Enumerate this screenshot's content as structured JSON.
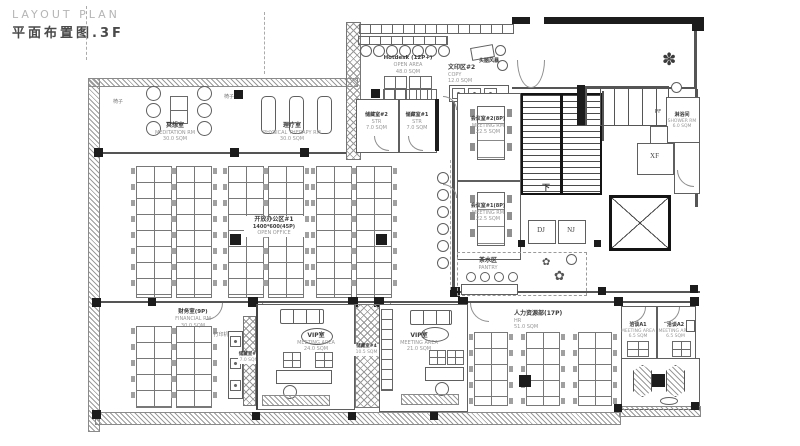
{
  "title": {
    "en": "LAYOUT PLAN",
    "zh": "平面布置图.3F"
  },
  "rooms": {
    "meditation": {
      "name": "冥想室",
      "sub": "MEDITATION RM",
      "area": "30.0 SQM"
    },
    "therapy": {
      "name": "理疗室",
      "sub": "PHYSICAL THERAPY RM",
      "area": "30.0 SQM"
    },
    "hotdesk": {
      "name": "Hotdesk (12P+)",
      "sub": "OPEN AREA",
      "area": "48.0 SQM"
    },
    "brainstorm": {
      "name": "头脑风暴"
    },
    "copy": {
      "name": "文印区#2",
      "sub": "COPY",
      "area": "12.0 SQM"
    },
    "storage2": {
      "name": "储藏室#2",
      "sub": "STR",
      "area": "7.0 SQM"
    },
    "storage1": {
      "name": "储藏室#1",
      "sub": "STR",
      "area": "7.0 SQM"
    },
    "meeting2": {
      "name": "会议室#2(8P)",
      "sub": "MEETING RM",
      "area": "22.5 SQM"
    },
    "meeting1": {
      "name": "会议室#1(8P)",
      "sub": "MEETING RM",
      "area": "22.5 SQM"
    },
    "open_office": {
      "name": "开放办公区#1",
      "sub": "1400*600(45P)",
      "area": "OPEN OFFICE"
    },
    "pantry": {
      "name": "茶水区",
      "sub": "PANTRY"
    },
    "finance": {
      "name": "财务室(9P)",
      "sub": "FINANCIAL RM",
      "area": "30.0 SQM"
    },
    "printer": {
      "name": "打印机"
    },
    "storage3": {
      "name": "储藏室#3",
      "sub": "STR",
      "area": "7.0 SQM"
    },
    "vip1": {
      "name": "VIP室",
      "sub": "MEETING AREA",
      "area": "24.0 SQM"
    },
    "storage4": {
      "name": "储藏室#4",
      "sub": "STR",
      "area": "10.5 SQM"
    },
    "vip2": {
      "name": "VIP室",
      "sub": "MEETING AREA",
      "area": "21.0 SQM"
    },
    "hr": {
      "name": "人力资源部(17P)",
      "sub": "HR",
      "area": "51.0 SQM"
    },
    "meet_a1": {
      "name": "洽谈A1",
      "sub": "MEETING AREA",
      "area": "6.5 SQM"
    },
    "meet_a2": {
      "name": "洽谈A2",
      "sub": "MEETING AREA",
      "area": "6.5 SQM"
    },
    "shower": {
      "name": "淋浴间",
      "sub": "SHOWER RM",
      "area": "6.0 SQM"
    }
  },
  "labels": {
    "stair_down": "下",
    "dj": "DJ",
    "nj": "NJ",
    "xf": "XF",
    "pf": "PF",
    "chair": "椅子"
  },
  "icons": {
    "plant": "✽",
    "flower": "✿"
  },
  "colors": {
    "wall": "#1c1c1c",
    "line": "#555555",
    "text_zh": "#3a3a3a",
    "text_en": "#979797",
    "title_en": "#b5b5b5",
    "title_zh": "#4a4a4a"
  }
}
